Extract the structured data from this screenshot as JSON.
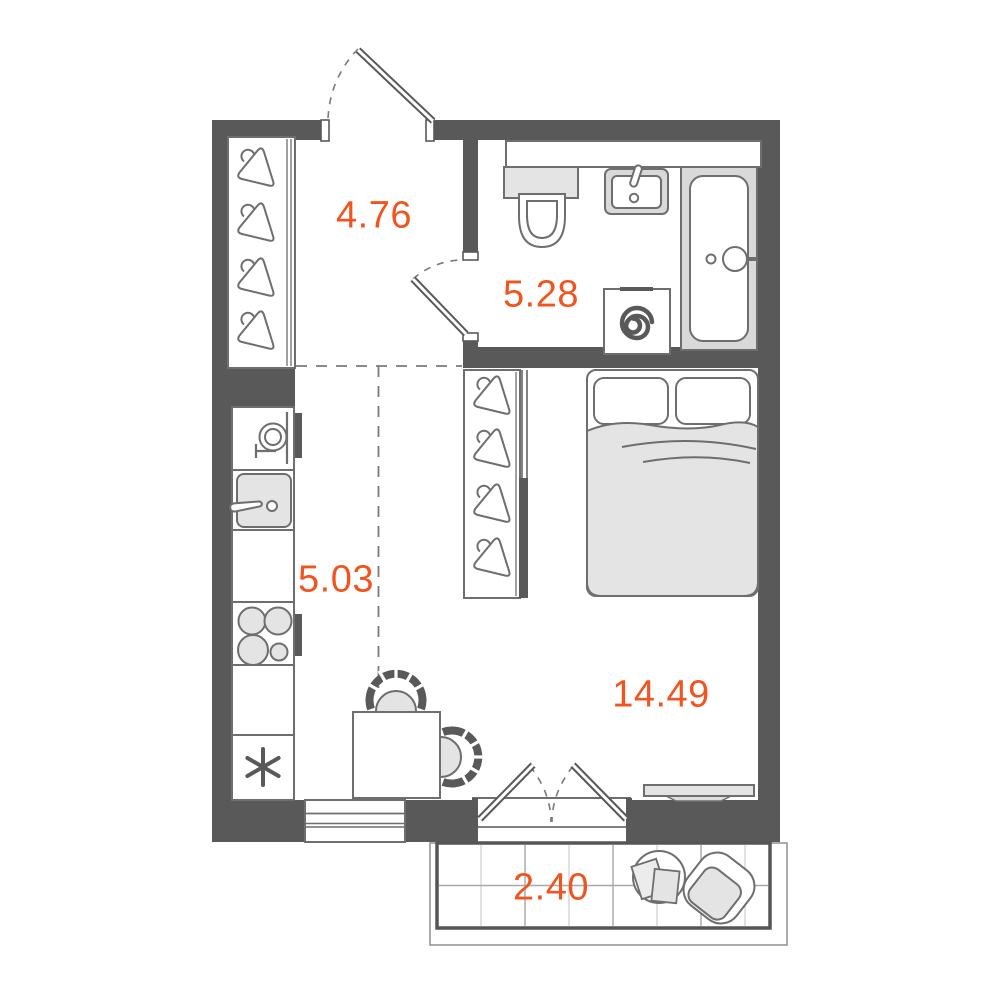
{
  "floor_plan": {
    "type": "apartment-floor-plan",
    "rooms": [
      {
        "name": "hallway",
        "area_label": "4.76"
      },
      {
        "name": "bathroom",
        "area_label": "5.28"
      },
      {
        "name": "kitchen",
        "area_label": "5.03"
      },
      {
        "name": "living-room",
        "area_label": "14.49"
      },
      {
        "name": "balcony",
        "area_label": "2.40"
      }
    ],
    "colors": {
      "wall": "#595959",
      "outline": "#6E6E6E",
      "light_fill": "#E4E4E4",
      "area_label": "#F1551F",
      "background": "#FFFFFF"
    },
    "furniture": {
      "hallway": [
        "wardrobe-with-4-hangers"
      ],
      "bathroom": [
        "shelf",
        "toilet",
        "washbasin",
        "washing-machine",
        "bathtub"
      ],
      "kitchen": [
        "faucet-sink-unit",
        "basin",
        "counter",
        "stove-4-burners",
        "fridge",
        "dining-table",
        "two-chairs"
      ],
      "living_room": [
        "wardrobe-with-4-hangers",
        "double-bed",
        "tv-console"
      ],
      "balcony": [
        "round-table",
        "papers",
        "armchair"
      ]
    }
  }
}
